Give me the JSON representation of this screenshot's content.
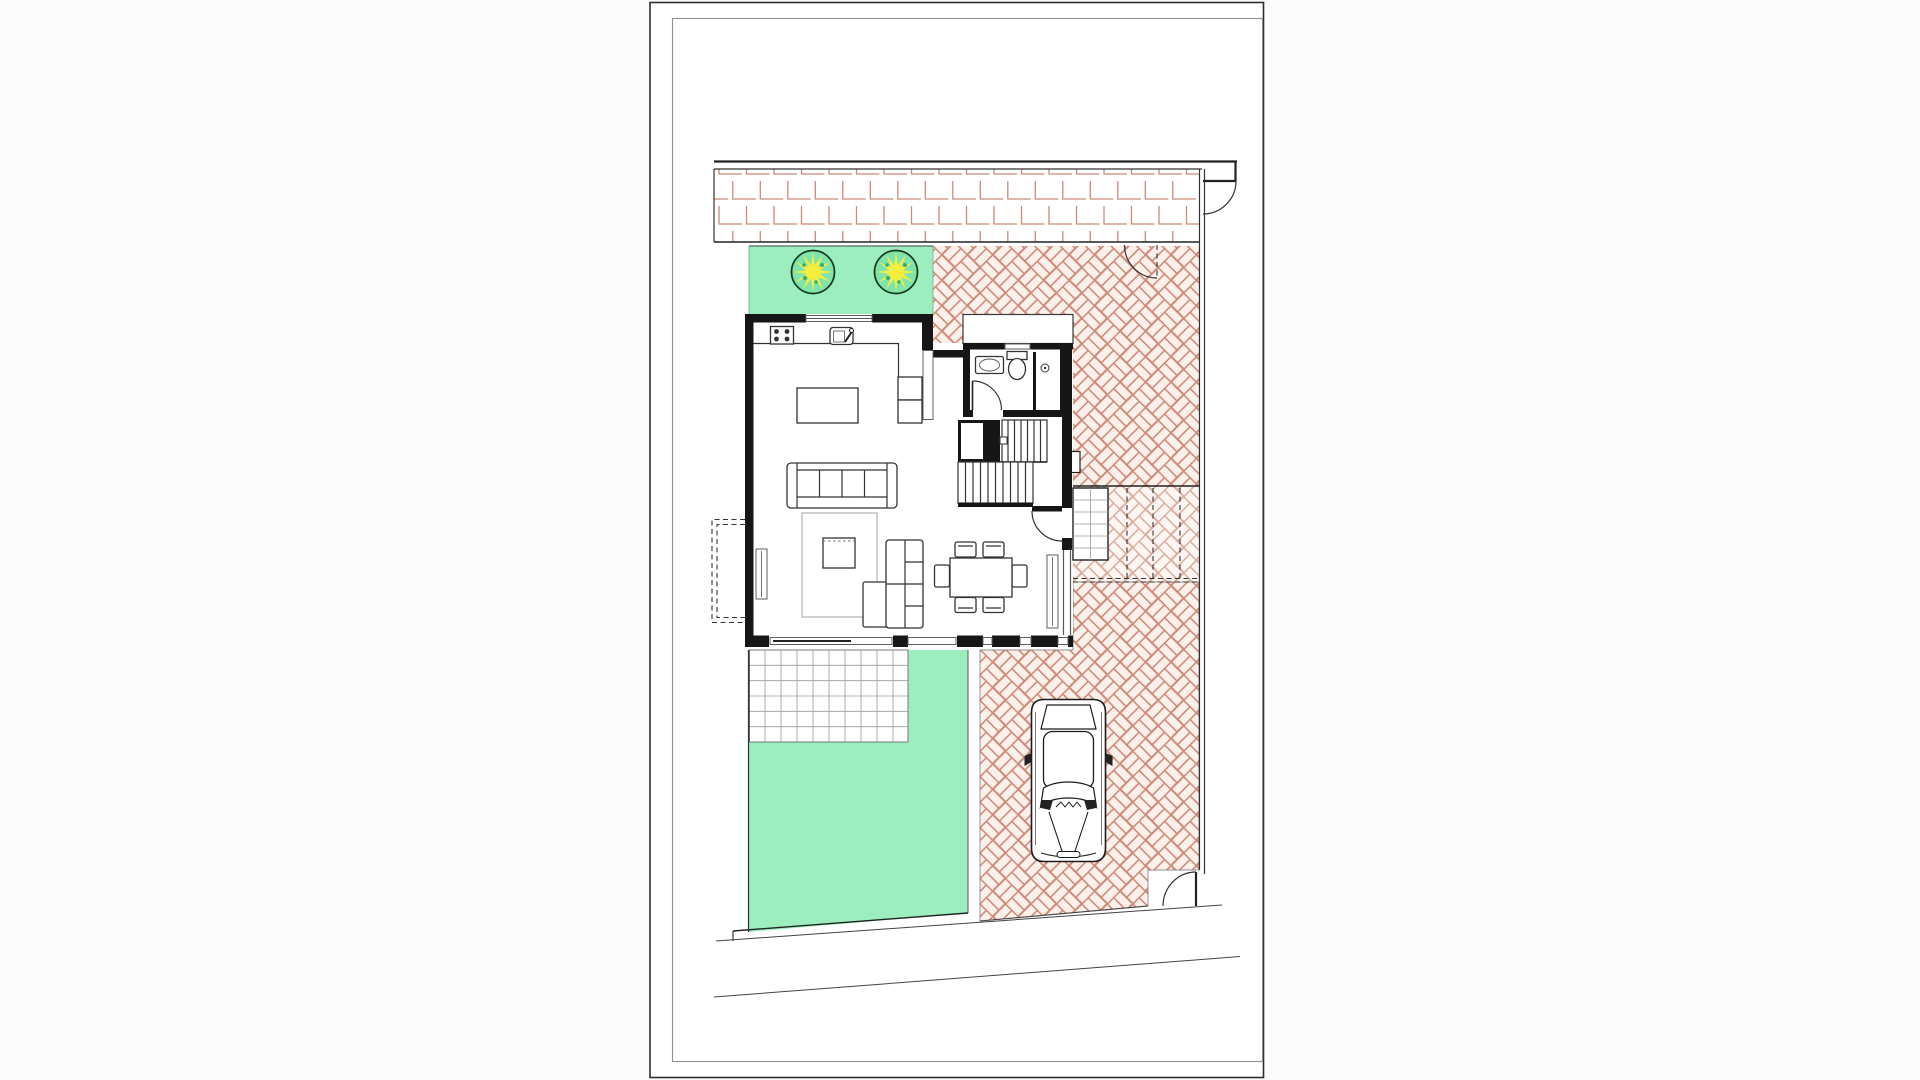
{
  "meta": {
    "type": "architectural-floor-plan-sheet",
    "description": "Ground-floor / site plan of a detached villa on a white drawing sheet",
    "visible_text": []
  },
  "colors": {
    "canvas": "#fcfcfc",
    "paper": "#ffffff",
    "frame_outer": "#2e2e2e",
    "frame_inner": "#8f8f8f",
    "wall": "#161616",
    "line": "#333333",
    "thin": "#5f5f5f",
    "grid": "#9b9b9b",
    "salmon": "#cf8a78",
    "salmon_light": "#dcab9b",
    "herr_bg": "#fcf0ea",
    "herr_bg_light": "#fdf6f2",
    "lawn": "#9deebe",
    "lawn_edge": "#4d7c63",
    "tree_fill": "#7fe4ac",
    "tree_stroke": "#17391d",
    "star": "#f5ee3e",
    "speckle": "#2fae7c",
    "bound": "#222222"
  },
  "plan": {
    "site": {
      "north_sidewalk_pattern": "running-bond brick, 3 rows",
      "courtyard_pattern": "herringbone paving",
      "gates": 3,
      "boundary_walls": "top and right, double line",
      "street_edges": "two slightly sloped lines at bottom"
    },
    "regions": [
      {
        "name": "sidewalk-pavement",
        "fill": "white",
        "stroke": "salmon"
      },
      {
        "name": "garden-strip-top",
        "fill": "lawn",
        "trees": 2
      },
      {
        "name": "courtyard-driveway",
        "fill": "herr_bg",
        "stroke": "salmon"
      },
      {
        "name": "entry-ramp-steps",
        "dashed_guides": 3
      },
      {
        "name": "terrace-tiles",
        "grid": "square tiles ~16px"
      },
      {
        "name": "rear-lawn",
        "fill": "lawn"
      },
      {
        "name": "road",
        "lines": 2
      }
    ],
    "house": {
      "rooms": [
        "kitchen-living-dining",
        "bathroom",
        "stair-hall",
        "closet"
      ],
      "kitchen": [
        "stove-4-burners",
        "sink-with-tap",
        "counter",
        "island",
        "tall-cabinets-2"
      ],
      "bathroom": [
        "washbasin",
        "toilet",
        "shower"
      ],
      "living": [
        "sofa-4-seats",
        "rug",
        "coffee-table",
        "lounge-chair",
        "ottoman"
      ],
      "dining": [
        "table",
        "chairs-6",
        "radiator"
      ],
      "stairs": "U-shaped, two flights",
      "doors": [
        "entry-door-east",
        "bathroom-door",
        "porch-canopy"
      ]
    },
    "car": {
      "present": true,
      "orientation": "front-to-street",
      "location": "driveway"
    }
  }
}
